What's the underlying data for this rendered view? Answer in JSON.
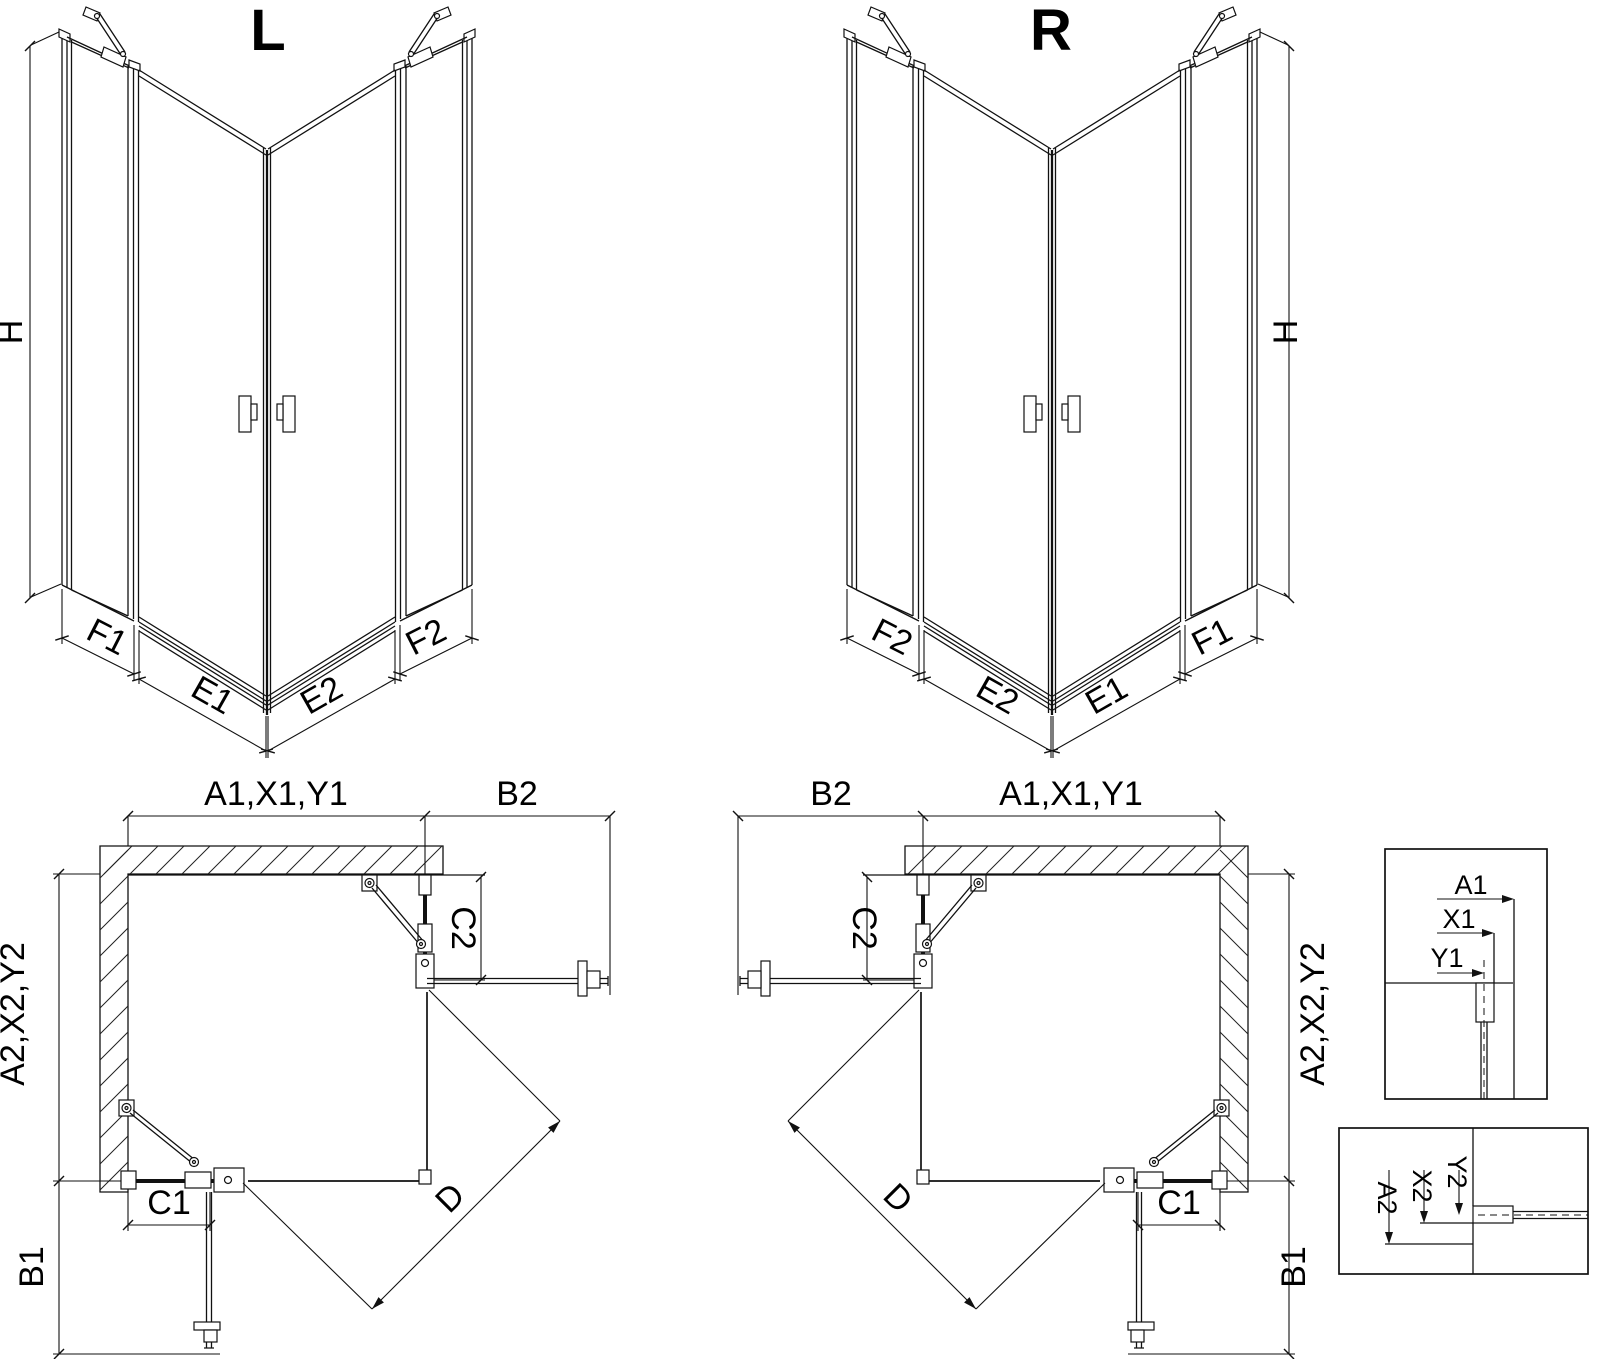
{
  "views": {
    "iso_left": {
      "title": "L",
      "dims": {
        "height": "H",
        "f1": "F1",
        "e1": "E1",
        "e2": "E2",
        "f2": "F2"
      }
    },
    "iso_right": {
      "title": "R",
      "dims": {
        "height": "H",
        "f1": "F1",
        "e1": "E1",
        "e2": "E2",
        "f2": "F2"
      }
    },
    "plan_left": {
      "dims": {
        "top_width": "A1,X1,Y1",
        "door_side": "B2",
        "fixed_side": "C2",
        "side_height": "A2,X2,Y2",
        "fixed_bottom": "C1",
        "door_bottom": "B1",
        "diagonal": "D"
      }
    },
    "plan_right": {
      "dims": {
        "top_width": "A1,X1,Y1",
        "door_side": "B2",
        "fixed_side": "C2",
        "side_height": "A2,X2,Y2",
        "fixed_bottom": "C1",
        "door_bottom": "B1",
        "diagonal": "D"
      }
    },
    "detail_wall_profile": {
      "dims": {
        "a1": "A1",
        "x1": "X1",
        "y1": "Y1"
      }
    },
    "detail_floor_profile": {
      "dims": {
        "a2": "A2",
        "x2": "X2",
        "y2": "Y2"
      }
    }
  }
}
